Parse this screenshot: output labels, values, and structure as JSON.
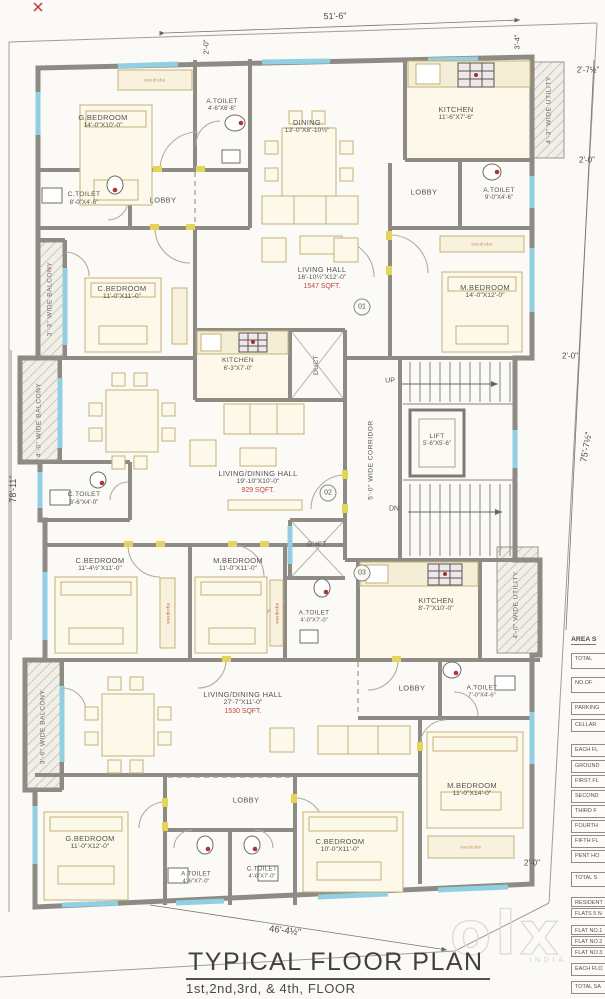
{
  "site": {
    "dim_top": "51'-6\"",
    "dim_top_left_inner": "2'-0\"",
    "dim_top_right": "3'-4\"",
    "dim_right_1": "2'-7½\"",
    "dim_right_2": "2'-0\"",
    "dim_right_3": "2'-0\"",
    "dim_left": "78'-11\"",
    "dim_right_main": "75'-7½\"",
    "dim_bottom": "46'-4½\"",
    "dim_bottom_right": "2'-0\""
  },
  "flats": {
    "f1": "01",
    "f2": "02",
    "f3": "03"
  },
  "rooms": {
    "gbed1": {
      "name": "G.BEDROOM",
      "dims": "14'-0\"X10'-0\""
    },
    "atoilet1": {
      "name": "A.TOILET",
      "dims": "4'-6\"X6'-6\""
    },
    "ctoilet1": {
      "name": "C.TOILET",
      "dims": "8'-0\"X4'-6\""
    },
    "lobby1": {
      "name": "LOBBY"
    },
    "dining1": {
      "name": "DINING",
      "dims": "13'-0\"X8'-10½\""
    },
    "kitchen1": {
      "name": "KITCHEN",
      "dims": "11'-6\"X7'-6\""
    },
    "lobby1r": {
      "name": "LOBBY"
    },
    "atoilet1r": {
      "name": "A.TOILET",
      "dims": "9'-0\"X4'-6\""
    },
    "cbed1": {
      "name": "C.BEDROOM",
      "dims": "11'-0\"X11'-0\""
    },
    "living1": {
      "name": "LIVING HALL",
      "dims": "16'-10½\"X12'-0\"",
      "area": "1547 SQFT."
    },
    "mbed1": {
      "name": "M.BEDROOM",
      "dims": "14'-0\"X12'-0\""
    },
    "kitchen1s": {
      "name": "KITCHEN",
      "dims": "6'-3\"X7'-0\""
    },
    "duct1": {
      "name": "DUCT"
    },
    "living2": {
      "name": "LIVING/DINING HALL",
      "dims": "19'-10\"X10'-0\"",
      "area": "929 SQFT."
    },
    "ctoilet2": {
      "name": "C.TOILET",
      "dims": "6'-6\"X4'-0\""
    },
    "cbed2": {
      "name": "C.BEDROOM",
      "dims": "11'-4½\"X11'-0\""
    },
    "mbed2": {
      "name": "M.BEDROOM",
      "dims": "11'-0\"X11'-0\""
    },
    "atoilet2": {
      "name": "A.TOILET",
      "dims": "4'-0\"X7'-0\""
    },
    "duct2": {
      "name": "DUCT"
    },
    "kitchen3": {
      "name": "KITCHEN",
      "dims": "8'-7\"X10'-0\""
    },
    "lobby3": {
      "name": "LOBBY"
    },
    "atoilet3r": {
      "name": "A.TOILET",
      "dims": "7'-0\"X4'-6\""
    },
    "living3": {
      "name": "LIVING/DINING HALL",
      "dims": "27'-7\"X11'-0\"",
      "area": "1530 SQFT."
    },
    "lobby3b": {
      "name": "LOBBY"
    },
    "gbed3": {
      "name": "G.BEDROOM",
      "dims": "11'-0\"X12'-0\""
    },
    "atoilet3": {
      "name": "A.TOILET",
      "dims": "4'-6\"X7'-0\""
    },
    "ctoilet3": {
      "name": "C.TOILET",
      "dims": "4'-6\"X7'-0\""
    },
    "cbed3": {
      "name": "C.BEDROOM",
      "dims": "10'-0\"X11'-0\""
    },
    "mbed3": {
      "name": "M.BEDROOM",
      "dims": "11'-0\"X14'-0\""
    }
  },
  "core": {
    "lift": {
      "name": "LIFT",
      "dims": "5'-6\"X5'-6\""
    },
    "corridor": "5'-0\" WIDE CORRIDOR",
    "up": "UP",
    "dn": "DN"
  },
  "balconies": {
    "b1": "3'-3\" WIDE BALCONY",
    "b2": "4'-0\" WIDE BALCONY",
    "b3": "3'-6\" WIDE BALCONY",
    "u1": "4'-3\" WIDE UTILITY",
    "u2": "4'-0\" WIDE UTILITY"
  },
  "misc": {
    "wardrobe": "wardrobe"
  },
  "title": {
    "main": "TYPICAL FLOOR PLAN",
    "sub": "1st,2nd,3rd, & 4th, FLOOR"
  },
  "area_table": {
    "header": "AREA S",
    "rows": [
      "TOTAL",
      "NO.OF",
      "PARKING",
      "CELLAR",
      "EACH FL",
      "GROUND",
      "FIRST FL",
      "SECOND",
      "THIRD F",
      "FOURTH",
      "FIFTH FL",
      "PENT HO",
      "TOTAL S",
      "RESIDENT",
      "FLATS 5 N",
      "FLAT NO.1",
      "FLAT NO.2",
      "FLAT NO.3",
      "EACH FLO",
      "TOTAL SA"
    ]
  },
  "watermark": {
    "brand": "olx",
    "country": "INDIA"
  },
  "colors": {
    "wall": "#8e8b84",
    "window": "#93cfe3",
    "door_frame": "#e6d45a",
    "area_red": "#c2453e",
    "furniture": "#c3b276"
  }
}
